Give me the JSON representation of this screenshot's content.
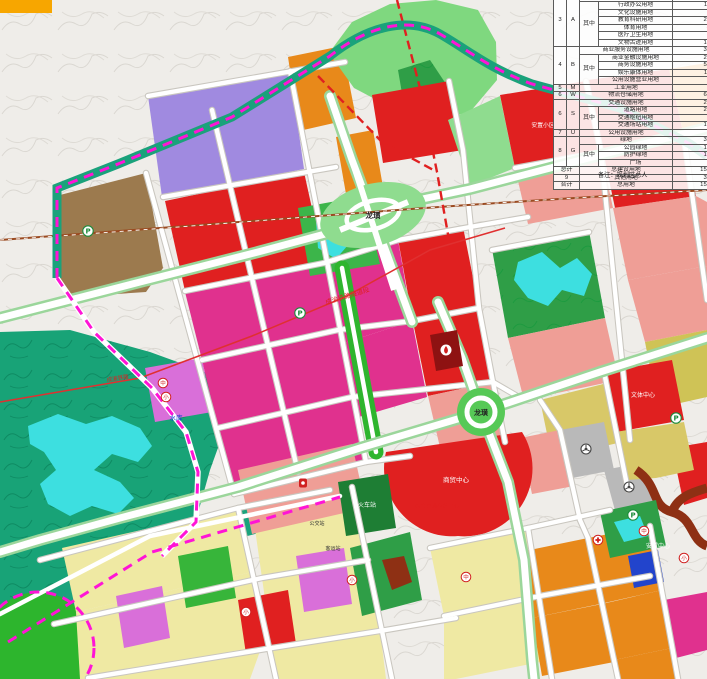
{
  "labels": {
    "interchange_north": "龙璜",
    "interchange_south": "龙璜",
    "railway_tunnel": "成渝铁路隧道段",
    "railway_west": "成渝铁路",
    "reservoir": "水库",
    "cultural_sports_center": "文体中心",
    "resettlement_center": "安置中心",
    "commercial_center": "商贸中心",
    "railway_station": "火车站",
    "transport_hub": "综合交通枢纽中心",
    "bus_station": "公交站",
    "coach_station": "客运站",
    "resettlement_area": "安置小区"
  },
  "icons": {
    "parking": "P",
    "school_middle": "中",
    "school_primary": "小"
  },
  "colors": {
    "boundary_dash": "#ff14d6",
    "railway_planned": "#e02020",
    "commercial_red": "#e02020",
    "market_magenta": "#e0318e",
    "industrial_purple": "#a08ae0",
    "warehouse_brown": "#9c7a4e",
    "residential_salmon": "#ef9e96",
    "village_yellow": "#efe9a3",
    "park_green": "#37b53a",
    "forest_teal": "#18a377",
    "water_cyan": "#3ddfe0",
    "orange_mixed": "#e8891a"
  },
  "table": {
    "r0": {
      "no": "3",
      "code": "A",
      "name": "公共管理与公共服务设施用地",
      "val": "45"
    },
    "r1": {
      "qz": "其中",
      "name": "行政办公用地",
      "val": "11"
    },
    "r2": {
      "name": "文化设施用地",
      "val": "6"
    },
    "r3": {
      "name": "教育科研用地",
      "val": "23"
    },
    "r4": {
      "name": "体育用地",
      "val": "4"
    },
    "r5": {
      "name": "医疗卫生用地",
      "val": "8"
    },
    "r6": {
      "name": "文物古迹用地",
      "val": "14"
    },
    "r7": {
      "no": "4",
      "code": "B",
      "name": "商业服务设施用地",
      "val": "36"
    },
    "r8": {
      "qz": "其中",
      "name": "商业金融设施用地",
      "val": "29"
    },
    "r9": {
      "name": "商务设施用地",
      "val": "53"
    },
    "r10": {
      "name": "娱乐康体用地",
      "val": "11"
    },
    "r11": {
      "name": "公用设施营业用地",
      "val": "0"
    },
    "r12": {
      "no": "5",
      "code": "M",
      "name": "工业用地",
      "val": "2"
    },
    "r13": {
      "no": "6",
      "code": "W",
      "name": "物流仓储用地",
      "val": "68"
    },
    "r14": {
      "no": "6",
      "code": "S",
      "name": "交通设施用地",
      "val": "23"
    },
    "r15": {
      "qz": "其中",
      "name": "道路用地",
      "val": "20"
    },
    "r16": {
      "name": "交通枢纽用地",
      "val": "2"
    },
    "r17": {
      "name": "交通场站用地",
      "val": "16"
    },
    "r18": {
      "no": "7",
      "code": "U",
      "name": "公用设施用地",
      "val": "3"
    },
    "r19": {
      "no": "8",
      "code": "G",
      "name": "绿地",
      "val": "32"
    },
    "r20": {
      "qz": "其中",
      "name": "公园绿地",
      "val": "17"
    },
    "r21": {
      "name": "防护绿地",
      "val": "13"
    },
    "r22": {
      "name": "广场",
      "val": "2"
    },
    "r23": {
      "no": "总计",
      "name": "总建设用地",
      "val": "152"
    },
    "r24": {
      "no": "9",
      "name": "其他用地",
      "val": "38"
    },
    "r25": {
      "no": "合计",
      "name": "总用地",
      "val": "158"
    },
    "note": "备注：规划区总人"
  }
}
